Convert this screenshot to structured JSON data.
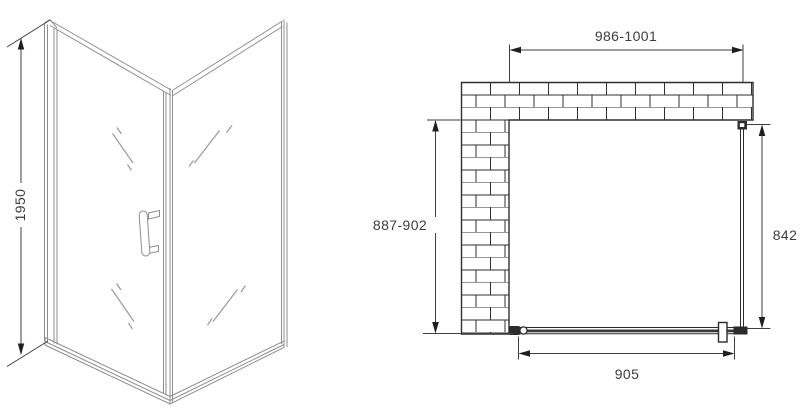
{
  "drawing": {
    "type": "technical-drawing",
    "views": {
      "perspective": "corner shower enclosure, front perspective",
      "plan": "top plan view with brick wall"
    }
  },
  "labels": {
    "height": "1950",
    "top_width": "986-1001",
    "side_depth": "887-902",
    "fixed_glass": "842",
    "door_width": "905"
  },
  "colors": {
    "background": "#ffffff",
    "frame_line": "#8e8e8e",
    "glass_mark": "#9a9a9a",
    "plan_line": "#2b2b2b",
    "dimension_line": "#3f3f3f",
    "arrow_fill": "#1f1f1f",
    "text": "#3d3d3d"
  }
}
